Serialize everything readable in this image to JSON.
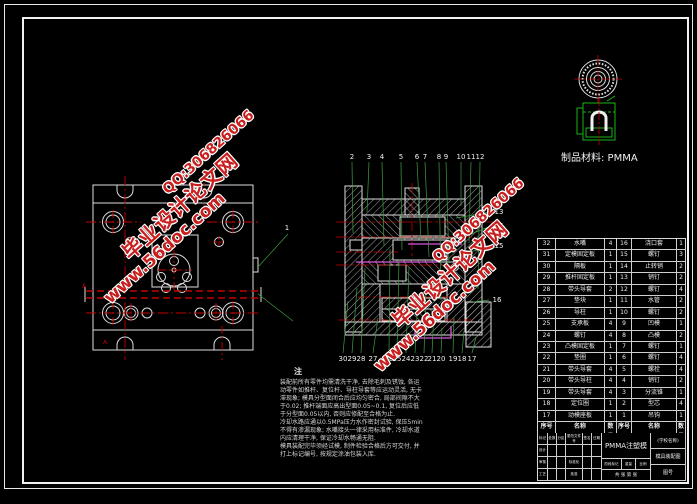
{
  "colors": {
    "background": "#000000",
    "line_white": "#e8e8e8",
    "centerline_red": "#c40000",
    "leader_green": "#3fa03f",
    "product_green": "#18b418",
    "cavity_magenta": "#dd55dd",
    "watermark_red": "#c81e1e"
  },
  "watermark": {
    "qq": "QQ:306826066",
    "site_name": "毕业设计论文网",
    "url": "www.56doc.com"
  },
  "material_label": "制品材料: PMMA",
  "section_view": {
    "top_labels": [
      "2",
      "3",
      "4",
      "5",
      "6",
      "7",
      "8",
      "9",
      "10",
      "11",
      "12"
    ],
    "right_labels": [
      "13",
      "14",
      "15",
      "16"
    ],
    "bottom_labels": [
      "30",
      "29",
      "28",
      "27",
      "26",
      "25",
      "24",
      "23",
      "22",
      "21",
      "20",
      "19",
      "18",
      "17"
    ],
    "plan_labels": [
      "1"
    ],
    "detail_labels": [
      "A",
      "A"
    ]
  },
  "notes": {
    "title": "注",
    "lines": [
      "装配前所有零件均需清洗干净, 去除毛刺及锈蚀, 各运",
      "动零件如推杆、复位杆、导柱导套等应运动灵活, 无卡",
      "滞现象; 模具分型面闭合后应均匀密合, 局部间隙不大",
      "于0.02; 推杆端面应高出型面0.05~0.1, 复位后应低",
      "于分型面0.05以内, 否则应修配至合格为止.",
      "冷却水路应通以0.5MPa压力水作密封试验, 保压5min",
      "不得有渗漏现象; 水嘴接头一律采用标准件, 冷却水道",
      "内应清理干净, 保证冷却水畅通无阻.",
      "模具装配完毕须经试模, 制件检验合格后方可交付, 并",
      "打上标记编号, 按规定涂油包装入库."
    ]
  },
  "bom": {
    "headers": [
      "序号",
      "名称",
      "数量",
      "序号",
      "名称",
      "数量"
    ],
    "rows": [
      [
        "32",
        "水嘴",
        "4",
        "16",
        "浇口套",
        "1"
      ],
      [
        "31",
        "定模固定板",
        "1",
        "15",
        "螺钉",
        "3"
      ],
      [
        "30",
        "隔板",
        "1",
        "14",
        "止转销",
        "2"
      ],
      [
        "29",
        "推杆固定板",
        "1",
        "13",
        "销钉",
        "2"
      ],
      [
        "28",
        "带头导套",
        "2",
        "12",
        "螺钉",
        "4"
      ],
      [
        "27",
        "垫块",
        "1",
        "11",
        "水管",
        "2"
      ],
      [
        "26",
        "导柱",
        "1",
        "10",
        "螺钉",
        "2"
      ],
      [
        "25",
        "支承板",
        "4",
        "9",
        "凹模",
        "1"
      ],
      [
        "24",
        "螺钉",
        "4",
        "8",
        "凸模",
        "2"
      ],
      [
        "23",
        "凸模固定板",
        "1",
        "7",
        "螺钉",
        "1"
      ],
      [
        "22",
        "垫圈",
        "1",
        "6",
        "螺钉",
        "4"
      ],
      [
        "21",
        "带头导套",
        "4",
        "5",
        "螺栓",
        "4"
      ],
      [
        "20",
        "带头导柱",
        "4",
        "4",
        "销钉",
        "2"
      ],
      [
        "19",
        "带头导套",
        "4",
        "3",
        "分流锥",
        "1"
      ],
      [
        "18",
        "定位圈",
        "1",
        "2",
        "型芯",
        "4"
      ],
      [
        "17",
        "动模座板",
        "1",
        "1",
        "吊钩",
        "1"
      ]
    ]
  },
  "title_block": {
    "revision_headers": [
      "标记",
      "处数",
      "分区",
      "更改文件号",
      "签名",
      "日期"
    ],
    "role_design": "设计",
    "role_check": "审核",
    "role_process": "工艺",
    "role_standard": "标准化",
    "role_approve": "批准",
    "name_center": "PMMA注塑模",
    "stage_labels": [
      "阶段标记",
      "重量",
      "比例"
    ],
    "sheet_info": "共 张 第 张",
    "school": "(学校名称)",
    "drawing_name": "模具装配图",
    "drawing_no": "图号"
  }
}
